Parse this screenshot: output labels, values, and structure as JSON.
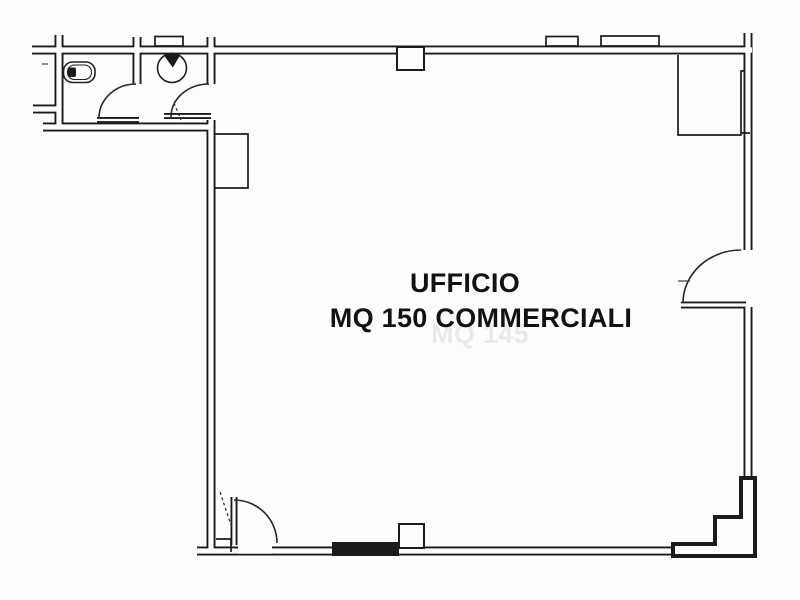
{
  "plan": {
    "room_label": {
      "line1": "UFFICIO",
      "line2": "MQ 150 COMMERCIALI",
      "ghost": "MQ 145"
    },
    "fixtures": [
      {
        "name": "toilet"
      },
      {
        "name": "washbasin"
      }
    ],
    "doors": [
      {
        "name": "wc-door"
      },
      {
        "name": "anteroom-door"
      },
      {
        "name": "side-entrance-door"
      },
      {
        "name": "bottom-entrance-door"
      }
    ],
    "structures": [
      {
        "name": "wall-recess"
      },
      {
        "name": "structural-pier"
      },
      {
        "name": "wall-pillar-top"
      },
      {
        "name": "wall-pillar-bottom"
      },
      {
        "name": "wall-pilaster-bump"
      }
    ],
    "colors": {
      "ink": "#1b1b1b",
      "paper": "#fdfdfc",
      "text": "#121212"
    }
  }
}
